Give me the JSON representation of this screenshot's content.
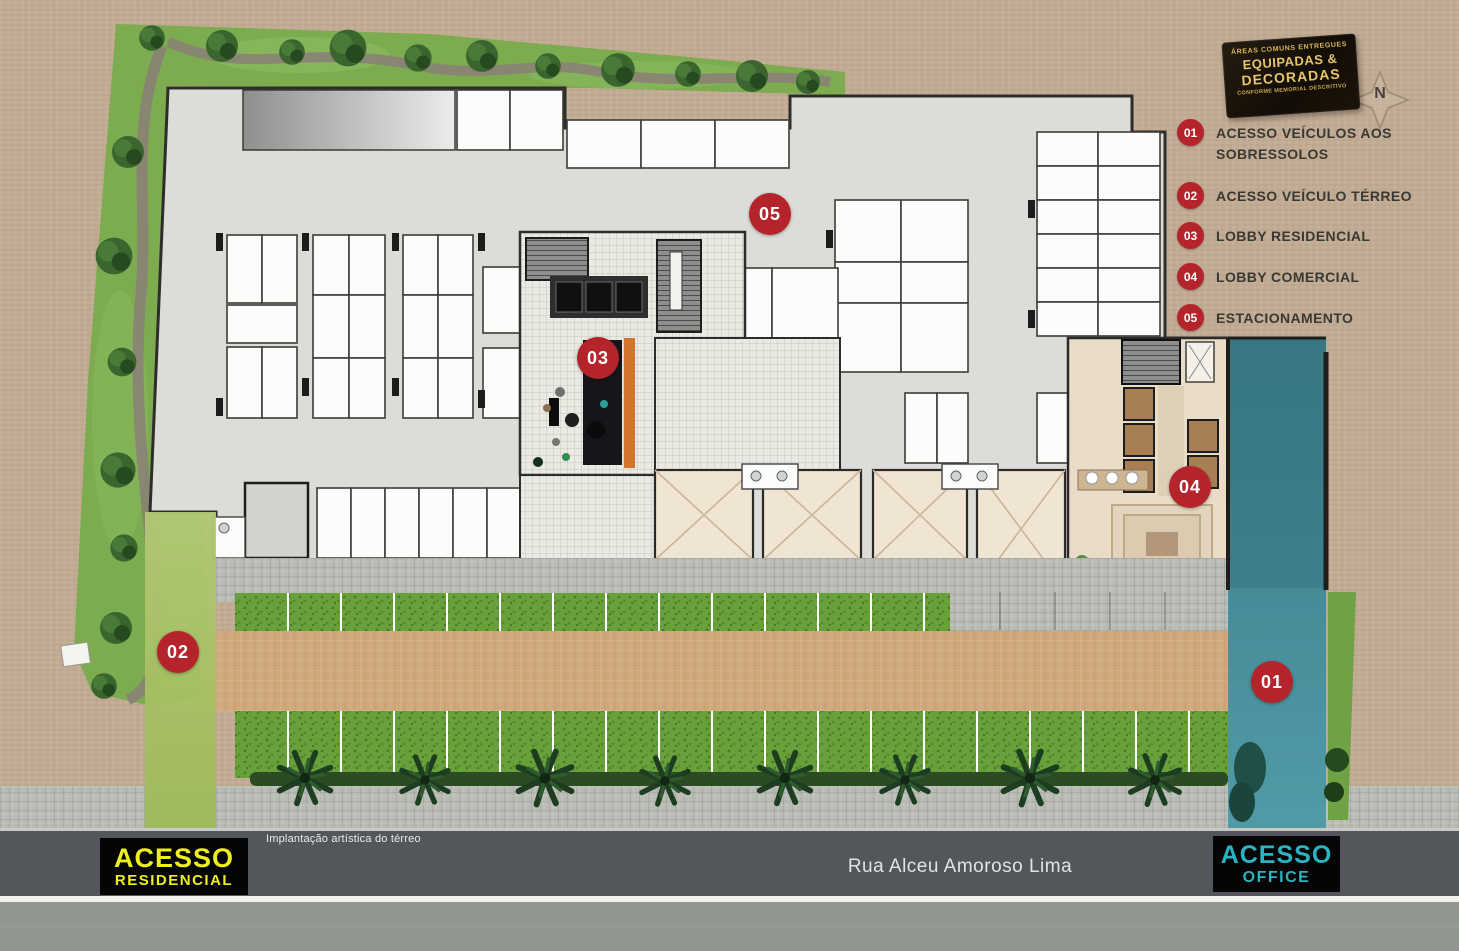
{
  "legend": {
    "badge": {
      "line1": "ÁREAS COMUNS ENTREGUES",
      "line2": "EQUIPADAS &",
      "line3": "DECORADAS",
      "line4": "CONFORME MEMORIAL DESCRITIVO"
    },
    "items": [
      {
        "num": "01",
        "label": "ACESSO VEÍCULOS AOS SOBRESSOLOS"
      },
      {
        "num": "02",
        "label": "ACESSO VEÍCULO TÉRREO"
      },
      {
        "num": "03",
        "label": "LOBBY RESIDENCIAL"
      },
      {
        "num": "04",
        "label": "LOBBY COMERCIAL"
      },
      {
        "num": "05",
        "label": "ESTACIONAMENTO"
      }
    ]
  },
  "compass": {
    "label": "N"
  },
  "markers": [
    {
      "num": "05"
    },
    {
      "num": "03"
    },
    {
      "num": "04"
    },
    {
      "num": "02"
    },
    {
      "num": "01"
    }
  ],
  "labels": {
    "access_residencial": {
      "line1": "ACESSO",
      "line2": "RESIDENCIAL"
    },
    "access_office": {
      "line1": "ACESSO",
      "line2": "OFFICE"
    },
    "street": "Rua Alceu Amoroso Lima",
    "caption": "Implantação artística do térreo"
  },
  "colors": {
    "marker_red": "#b5242b",
    "badge_gold": "#d8b75a",
    "access_residencial_text": "#edf01c",
    "access_office_text": "#2ab4c2",
    "teal_drive": "#4a93a0",
    "green_drive": "#a7c163",
    "background_tan": "#c1ab93",
    "road_gray": "#53565a",
    "building_floor": "#dcddd8"
  }
}
